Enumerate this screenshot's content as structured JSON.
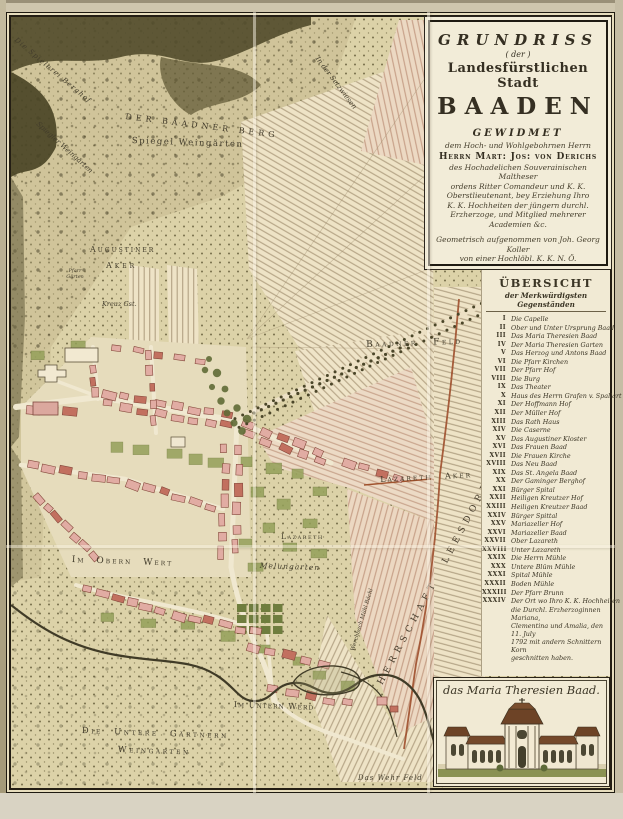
{
  "cartouche": {
    "title_line1": "GRUNDRISS",
    "title_line2": "( der )",
    "title_line3": "Landesfürstlichen Stadt",
    "title_line4": "BAADEN",
    "dedication_heading": "GEWIDMET",
    "dedication_intro": "dem Hoch- und Wohlgebohrnen Herrn",
    "dedicatee": "Herrn Mart: Jos: von Derichs",
    "dedication_lines": [
      "des Hochadelichen Souverainischen Maltheser",
      "ordens Ritter Comandeur und K. K.",
      "Oberstlieutenant, bey Erziehung Ihro",
      "K. K. Hochheiten der jüngern durchl.",
      "Erzherzoge, und Mitglied mehrerer",
      "Academien &c."
    ],
    "surveyor_lines": [
      "Geometrisch aufgenommen von Joh. Georg Koller",
      "von einer Hochlöbl. K. K. N. Ö. Landesregierung",
      "zu dieser Aufnahme höchst verordneter Ingenieur"
    ],
    "imprint": "Gestochen von Hieronymus Benedicti in Wien 1799"
  },
  "legend": {
    "title": "ÜBERSICHT",
    "subtitle": "der Merkwürdigsten Gegenständen",
    "entries": [
      {
        "num": "I",
        "text": "Die Capelle"
      },
      {
        "num": "II",
        "text": "Ober und Unter Ursprung Baad"
      },
      {
        "num": "III",
        "text": "Das Maria Theresien Baad"
      },
      {
        "num": "IV",
        "text": "Der Maria Theresien Garten"
      },
      {
        "num": "V",
        "text": "Das Herzog und Antons Baad"
      },
      {
        "num": "VI",
        "text": "Die Pfarr Kirchen"
      },
      {
        "num": "VII",
        "text": "Der Pfarr Hof"
      },
      {
        "num": "VIII",
        "text": "Die Burg"
      },
      {
        "num": "IX",
        "text": "Das Theater"
      },
      {
        "num": "X",
        "text": "Haus des Herrn Grafen v. Spallart"
      },
      {
        "num": "XI",
        "text": "Der Hoffmann Hof"
      },
      {
        "num": "XII",
        "text": "Der Müller Hof"
      },
      {
        "num": "XIII",
        "text": "Das Rath Haus"
      },
      {
        "num": "XIV",
        "text": "Die Caserne"
      },
      {
        "num": "XV",
        "text": "Das Augustiner Kloster"
      },
      {
        "num": "XVI",
        "text": "Das Frauen Baad"
      },
      {
        "num": "XVII",
        "text": "Die Frauen Kirche"
      },
      {
        "num": "XVIII",
        "text": "Das Neu Baad"
      },
      {
        "num": "XIX",
        "text": "Das St. Angela Baad"
      },
      {
        "num": "XX",
        "text": "Der Gaminger Berghof"
      },
      {
        "num": "XXI",
        "text": "Bürger Spital"
      },
      {
        "num": "XXII",
        "text": "Heiligen Kreutzer Hof"
      },
      {
        "num": "XXIII",
        "text": "Heiligen Kreutzer Baad"
      },
      {
        "num": "XXIV",
        "text": "Bürger Spittal"
      },
      {
        "num": "XXV",
        "text": "Mariazeller Hof"
      },
      {
        "num": "XXVI",
        "text": "Mariazeller Baad"
      },
      {
        "num": "XXVII",
        "text": "Ober Lazareth"
      },
      {
        "num": "XXVIII",
        "text": "Unter Lazareth"
      },
      {
        "num": "XXIX",
        "text": "Die Herrn Mühle"
      },
      {
        "num": "XXX",
        "text": "Untere Blüm Mühle"
      },
      {
        "num": "XXXI",
        "text": "Spital Mühle"
      },
      {
        "num": "XXXII",
        "text": "Boden Mühle"
      },
      {
        "num": "XXXIII",
        "text": "Der Pfarr Brunn"
      }
    ],
    "entry_34": {
      "num": "XXXIV",
      "lines": [
        "Der Ort wo Ihro K. K. Hochheiten",
        "die Durchl. Erzherzoginnen Mariana,",
        "Clementina und Amalia, den 11. July",
        "1792 mit andern Schnittern Korn",
        "geschnitten haben."
      ]
    }
  },
  "picture": {
    "caption": "das Maria Theresien Baad."
  },
  "map_labels": {
    "spielerei_berghof": "Die Spielerei Berghof",
    "baadner_berg": "Der Baadner Berg",
    "spiegel_weingarten": "Spiegel Weingärten",
    "spiegler_weingarten": "Spiegler Weingärten",
    "setzwiesen": "In der Setzwiesen",
    "augustiner_line1": "Augustiner",
    "augustiner_line2": "Aker",
    "pfarr_garten": "Pfarr Gärten",
    "kreuz_gst": "Kreuz Gst.",
    "baadner_feld": "Baadner Feld",
    "lazareth_aker": "Lazareth Aker",
    "lazareth": "Lazareth",
    "melungarten": "Melungarten",
    "im_obern_wert": "Im Obern Wert",
    "im_untern_werd": "Im Untern Werd",
    "untere_gaertnern_1": "Die Untere Gärtnern",
    "untere_gaertnern_2": "Weingarten",
    "wehr_feld": "Das Wehr Feld",
    "herrschaft_leesdorf": "Herrschaft Leesdorf",
    "werchbach": "Werchbach Mühl Bächl"
  }
}
